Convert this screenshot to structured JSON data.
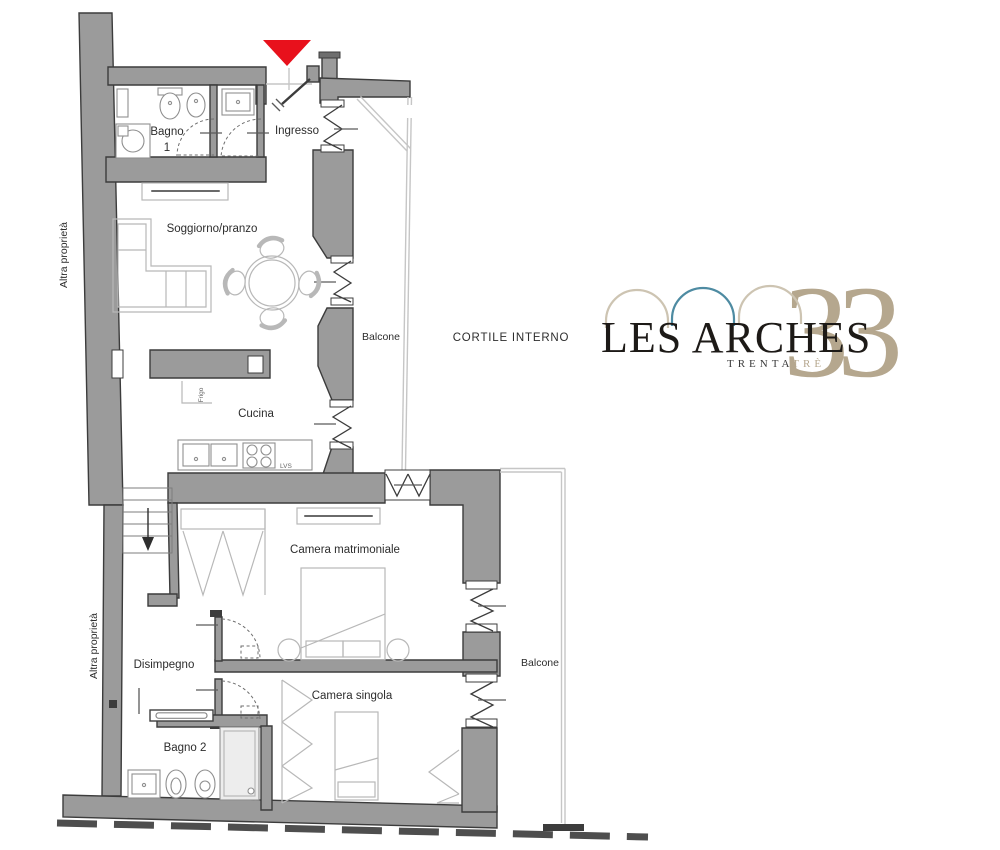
{
  "colors": {
    "wall_fill": "#9b9b9b",
    "wall_stroke": "#3c3c3c",
    "thin_line": "#c6c6c6",
    "furniture_line": "#b8b8b8",
    "fixture_line": "#8f8f8f",
    "label_text": "#2d2d2d",
    "small_text": "#666666",
    "marker_red": "#e8111c",
    "boundary_dash": "#4e4e4e",
    "logo_black": "#1d1a17",
    "logo_tan": "#b5a78e",
    "logo_tan_light": "#cdc4b2",
    "logo_teal": "#4e8ba2"
  },
  "labels": {
    "bagno1_line1": "Bagno",
    "bagno1_line2": "1",
    "ingresso": "Ingresso",
    "soggiorno": "Soggiorno/pranzo",
    "balcone_top": "Balcone",
    "cortile": "CORTILE INTERNO",
    "cucina": "Cucina",
    "frigo": "Frigo",
    "lvs": "LVS",
    "camera_matrimoniale": "Camera matrimoniale",
    "disimpegno": "Disimpegno",
    "camera_singola": "Camera singola",
    "bagno2": "Bagno 2",
    "balcone_right": "Balcone",
    "altra_proprieta_upper": "Altra proprietà",
    "altra_proprieta_lower": "Altra proprietà"
  },
  "logo": {
    "wordmark": "LES ARCHES",
    "number": "33",
    "subtitle_part1": "TRENTA",
    "subtitle_part2": "TRÈ"
  }
}
